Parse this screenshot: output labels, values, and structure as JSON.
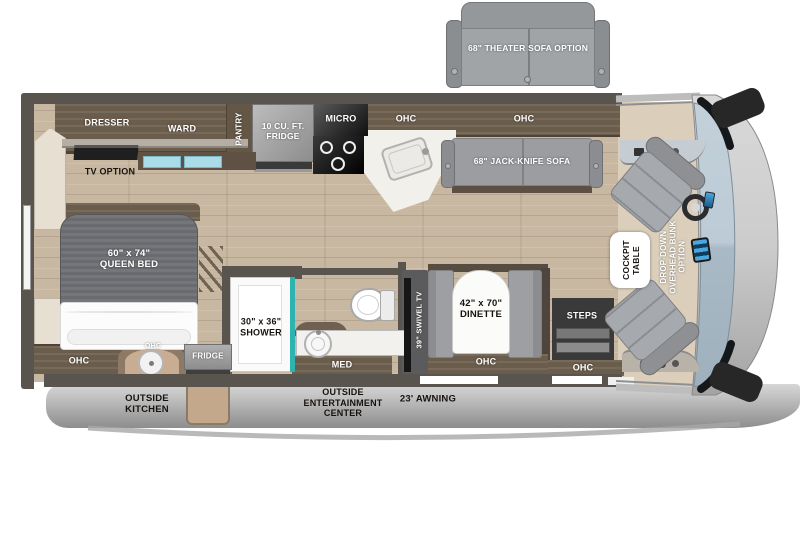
{
  "palette": {
    "wall": "#59544E",
    "floor_wood": "#C8B7A1",
    "cabinet_wood": "#6B5D4C",
    "counter_white": "#F4F2EE",
    "seat_gray": "#A6A9AD",
    "teal_accent": "#2FB3AE",
    "windshield_blue": "#B7C6D2",
    "body_gray": "#BDBDBD",
    "slide_tan": "#C4A88C",
    "drawer_blue": "#AADBE8"
  },
  "exterior": {
    "theater_sofa_label": "68\" THEATER SOFA OPTION",
    "awning_label": "23' AWNING",
    "outside_kitchen_label": "OUTSIDE\nKITCHEN",
    "outside_entertainment_label": "OUTSIDE\nENTERTAINMENT\nCENTER"
  },
  "bedroom": {
    "dresser_label": "DRESSER",
    "ward_label": "WARD",
    "pantry_label": "PANTRY",
    "tv_option_label": "TV OPTION",
    "queen_bed_label": "60\" x 74\"\nQUEEN BED",
    "ohc_label": "OHC"
  },
  "outside_kitchen": {
    "ohc_label": "OHC",
    "fridge_label": "FRIDGE"
  },
  "kitchen": {
    "fridge_label": "10 CU. FT.\nFRIDGE",
    "micro_label": "MICRO",
    "ohc_left_label": "OHC",
    "ohc_right_label": "OHC"
  },
  "living": {
    "jack_knife_sofa_label": "68\" JACK-KNIFE SOFA",
    "swivel_tv_label": "39\" SWIVEL TV",
    "dinette_label": "42\" x 70\"\nDINETTE",
    "dinette_ohc_label": "OHC",
    "steps_label": "STEPS",
    "entry_ohc_label": "OHC"
  },
  "bathroom": {
    "shower_label": "30\" x 36\"\nSHOWER",
    "med_label": "MED"
  },
  "cockpit": {
    "table_label": "COCKPIT\nTABLE",
    "bunk_label": "DROP-DOWN\nOVERHEAD BUNK\nOPTION"
  }
}
